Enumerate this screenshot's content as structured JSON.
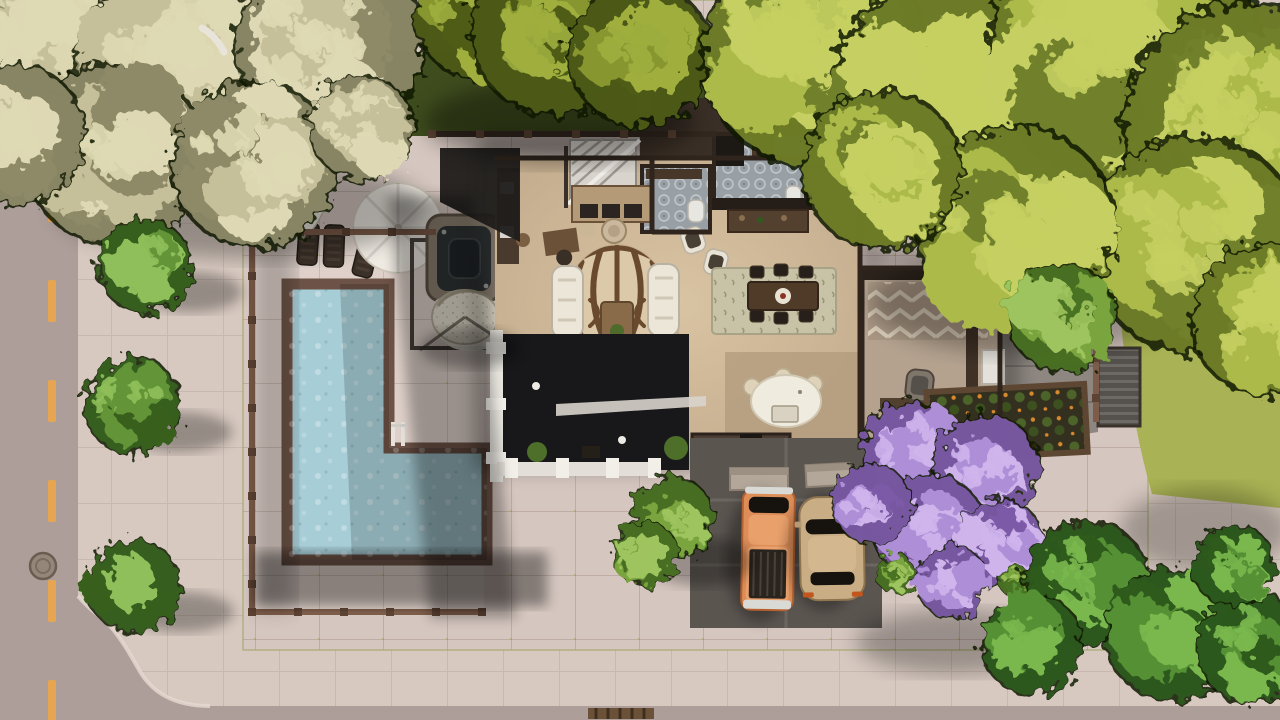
{
  "meta": {
    "view": "top-down aerial build view of a suburban residential lot",
    "scene_objects": [
      "road",
      "road-center-line",
      "manhole-cover",
      "storm-drain",
      "sidewalk",
      "street-trees",
      "lot-pavement",
      "pool-fence",
      "l-shaped-pool",
      "pool-ladder",
      "lounge-chairs",
      "patio-umbrella",
      "closed-umbrella",
      "hot-tub",
      "hanging-egg-chair",
      "fur-rug",
      "house",
      "staircase",
      "bathroom-1",
      "bathroom-2",
      "kitchen",
      "kitchen-island",
      "dining-rug",
      "dining-table",
      "dining-chairs",
      "island-stools",
      "living-sofas",
      "zebra-rug",
      "coffee-table",
      "armchairs",
      "dark-courtyard",
      "balcony-room",
      "garden-planter",
      "back-path",
      "corrugated-stair",
      "driveway",
      "driveway-planters",
      "pickup-truck",
      "sedan",
      "lilac-tree",
      "tree-canopies",
      "grass"
    ]
  },
  "colors": {
    "road": "#ad9e99",
    "road_line": "#eda64b",
    "sidewalk": "#cabcb5",
    "sidewalk_outer": "#d7c9c0",
    "plaza": "#d5c6bf",
    "patio": "#e0d1cb",
    "moss": "#96a246",
    "pool_water": "#a7cdd6",
    "pool_coping": "#6d5347",
    "fence": "#7d5c49",
    "fence_dark": "#33281f",
    "wood_floor": "#c5ae8f",
    "wood_floor_dark": "#b19a7c",
    "wall": "#2f251d",
    "white_trim": "#e9e6df",
    "dark_patio": "#18181b",
    "zebra_base": "#dbc9a9",
    "zebra_stripe": "#6a4a2e",
    "sofa": "#ece6d8",
    "rug_dining": "#c8c2a6",
    "table_wood": "#4f3b28",
    "chair_dark": "#27201a",
    "island": "#f0ebdf",
    "stool": "#ded3b9",
    "bath_tile": "#98a0a6",
    "driveway": "#5b5550",
    "path_gray": "#8e8781",
    "truck": "#dd8e58",
    "truck_bed": "#2a241e",
    "car": "#c9ad85",
    "glass": "#16130e",
    "tail_light": "#c2561d",
    "planter_box": "#b3a79a",
    "garden_soil": "#33301f",
    "flower_orange": "#d9892b",
    "hot_tub_rim": "#8d8071",
    "hot_tub_water": "#303435",
    "grass": "#a9b254",
    "grass_dark": "#3f4d1e",
    "egg_chair": "#e6e0d0",
    "umbrella": "#efeae2"
  },
  "palettes": {
    "pale": {
      "light": "#ded9b4",
      "base": "#c6c09a",
      "dark": "#8e8a68"
    },
    "oliveDeep": {
      "light": "#9fae3e",
      "base": "#87962f",
      "dark": "#4f5c18"
    },
    "chartreuse": {
      "light": "#c5cf62",
      "base": "#acba4a",
      "dark": "#71802a"
    },
    "fresh": {
      "light": "#9ec45e",
      "base": "#7aa43e",
      "dark": "#4a7222"
    },
    "deepGreen": {
      "light": "#7ab84e",
      "base": "#579035",
      "dark": "#2e5a1c"
    },
    "lilac": {
      "light": "#cfb4ec",
      "base": "#ae8ed6",
      "dark": "#7b5aa7"
    },
    "street": {
      "light": "#8fbf5a",
      "base": "#639539",
      "dark": "#39611f"
    }
  },
  "road": {
    "dashes": {
      "x": 48,
      "width": 8,
      "start_y": -20,
      "length": 42,
      "gap": 58,
      "count": 8
    }
  },
  "fences": [
    {
      "x1": 252,
      "y1": 232,
      "x2": 252,
      "y2": 612,
      "step": 44
    },
    {
      "x1": 252,
      "y1": 612,
      "x2": 482,
      "y2": 612,
      "step": 46
    },
    {
      "x1": 254,
      "y1": 232,
      "x2": 436,
      "y2": 232,
      "step": 46
    },
    {
      "x1": 1096,
      "y1": 238,
      "x2": 1096,
      "y2": 422,
      "step": 40
    },
    {
      "x1": 432,
      "y1": 134,
      "x2": 716,
      "y2": 134,
      "step": 48,
      "color": "#33281f"
    }
  ],
  "pool": {
    "loungers": [
      {
        "x": 308,
        "y": 244,
        "a": 4
      },
      {
        "x": 334,
        "y": 246,
        "a": 2
      },
      {
        "x": 366,
        "y": 256,
        "a": 14
      }
    ]
  },
  "dining": {
    "chairs": [
      [
        757,
        272
      ],
      [
        781,
        270
      ],
      [
        806,
        272
      ],
      [
        757,
        316
      ],
      [
        781,
        318
      ],
      [
        806,
        316
      ]
    ]
  },
  "island": {
    "stools": [
      [
        752,
        387
      ],
      [
        783,
        377
      ],
      [
        814,
        384
      ]
    ]
  },
  "trees": [
    {
      "name": "pale-olive-tree",
      "cx": 55,
      "cy": 35,
      "r": 115,
      "palette": "pale",
      "seed": 1
    },
    {
      "name": "pale-olive-tree",
      "cx": 195,
      "cy": 75,
      "r": 135,
      "palette": "pale",
      "seed": 2
    },
    {
      "name": "pale-olive-tree",
      "cx": 330,
      "cy": 45,
      "r": 105,
      "palette": "pale",
      "seed": 3
    },
    {
      "name": "pale-olive-tree",
      "cx": 115,
      "cy": 155,
      "r": 100,
      "palette": "pale",
      "seed": 4
    },
    {
      "name": "pale-olive-tree",
      "cx": 255,
      "cy": 165,
      "r": 92,
      "palette": "pale",
      "seed": 5
    },
    {
      "name": "pale-olive-tree",
      "cx": 15,
      "cy": 135,
      "r": 78,
      "palette": "pale",
      "seed": 6
    },
    {
      "name": "pale-olive-tree",
      "cx": 362,
      "cy": 128,
      "r": 58,
      "palette": "pale",
      "seed": 7
    },
    {
      "name": "olive-tree",
      "cx": 480,
      "cy": 15,
      "r": 72,
      "palette": "oliveDeep",
      "seed": 8
    },
    {
      "name": "olive-tree",
      "cx": 553,
      "cy": 32,
      "r": 92,
      "palette": "oliveDeep",
      "seed": 9
    },
    {
      "name": "olive-tree",
      "cx": 640,
      "cy": 54,
      "r": 80,
      "palette": "oliveDeep",
      "seed": 10
    },
    {
      "name": "chartreuse-tree",
      "cx": 815,
      "cy": 55,
      "r": 125,
      "palette": "chartreuse",
      "seed": 11
    },
    {
      "name": "chartreuse-tree",
      "cx": 965,
      "cy": 105,
      "r": 150,
      "palette": "chartreuse",
      "seed": 12
    },
    {
      "name": "chartreuse-tree",
      "cx": 1125,
      "cy": 45,
      "r": 150,
      "palette": "chartreuse",
      "seed": 13
    },
    {
      "name": "chartreuse-tree",
      "cx": 1245,
      "cy": 125,
      "r": 135,
      "palette": "chartreuse",
      "seed": 14
    },
    {
      "name": "chartreuse-tree",
      "cx": 1195,
      "cy": 245,
      "r": 120,
      "palette": "chartreuse",
      "seed": 15
    },
    {
      "name": "chartreuse-tree",
      "cx": 1015,
      "cy": 225,
      "r": 110,
      "palette": "chartreuse",
      "seed": 16
    },
    {
      "name": "chartreuse-tree",
      "cx": 882,
      "cy": 170,
      "r": 88,
      "palette": "chartreuse",
      "seed": 17
    },
    {
      "name": "chartreuse-tree",
      "cx": 1268,
      "cy": 320,
      "r": 85,
      "palette": "chartreuse",
      "seed": 18
    },
    {
      "name": "garden-tree",
      "cx": 1063,
      "cy": 318,
      "r": 60,
      "palette": "fresh",
      "seed": 19
    },
    {
      "name": "street-tree",
      "cx": 145,
      "cy": 266,
      "r": 52,
      "palette": "street",
      "seed": 20
    },
    {
      "name": "street-tree",
      "cx": 133,
      "cy": 406,
      "r": 54,
      "palette": "street",
      "seed": 21
    },
    {
      "name": "street-tree",
      "cx": 134,
      "cy": 586,
      "r": 52,
      "palette": "street",
      "seed": 22
    },
    {
      "name": "yard-tree",
      "cx": 672,
      "cy": 518,
      "r": 46,
      "palette": "fresh",
      "seed": 23
    },
    {
      "name": "yard-tree",
      "cx": 646,
      "cy": 554,
      "r": 36,
      "palette": "fresh",
      "seed": 24
    },
    {
      "name": "lilac-tree",
      "cx": 910,
      "cy": 450,
      "r": 54,
      "palette": "lilac",
      "seed": 25
    },
    {
      "name": "lilac-tree",
      "cx": 986,
      "cy": 466,
      "r": 58,
      "palette": "lilac",
      "seed": 26
    },
    {
      "name": "lilac-tree",
      "cx": 930,
      "cy": 530,
      "r": 62,
      "palette": "lilac",
      "seed": 27
    },
    {
      "name": "lilac-tree",
      "cx": 1000,
      "cy": 542,
      "r": 48,
      "palette": "lilac",
      "seed": 28
    },
    {
      "name": "lilac-tree",
      "cx": 872,
      "cy": 504,
      "r": 44,
      "palette": "lilac",
      "seed": 29
    },
    {
      "name": "lilac-tree",
      "cx": 952,
      "cy": 582,
      "r": 40,
      "palette": "lilac",
      "seed": 30
    },
    {
      "name": "lilac-leaf-accent",
      "cx": 896,
      "cy": 574,
      "r": 22,
      "palette": "fresh",
      "seed": 31
    },
    {
      "name": "lilac-leaf-accent",
      "cx": 1014,
      "cy": 580,
      "r": 18,
      "palette": "fresh",
      "seed": 32
    },
    {
      "name": "corner-tree",
      "cx": 1086,
      "cy": 583,
      "r": 70,
      "palette": "deepGreen",
      "seed": 33
    },
    {
      "name": "corner-tree",
      "cx": 1172,
      "cy": 634,
      "r": 74,
      "palette": "deepGreen",
      "seed": 34
    },
    {
      "name": "corner-tree",
      "cx": 1032,
      "cy": 644,
      "r": 56,
      "palette": "deepGreen",
      "seed": 35
    },
    {
      "name": "corner-tree",
      "cx": 1252,
      "cy": 648,
      "r": 62,
      "palette": "deepGreen",
      "seed": 36
    },
    {
      "name": "corner-tree",
      "cx": 1234,
      "cy": 566,
      "r": 46,
      "palette": "deepGreen",
      "seed": 37
    }
  ]
}
